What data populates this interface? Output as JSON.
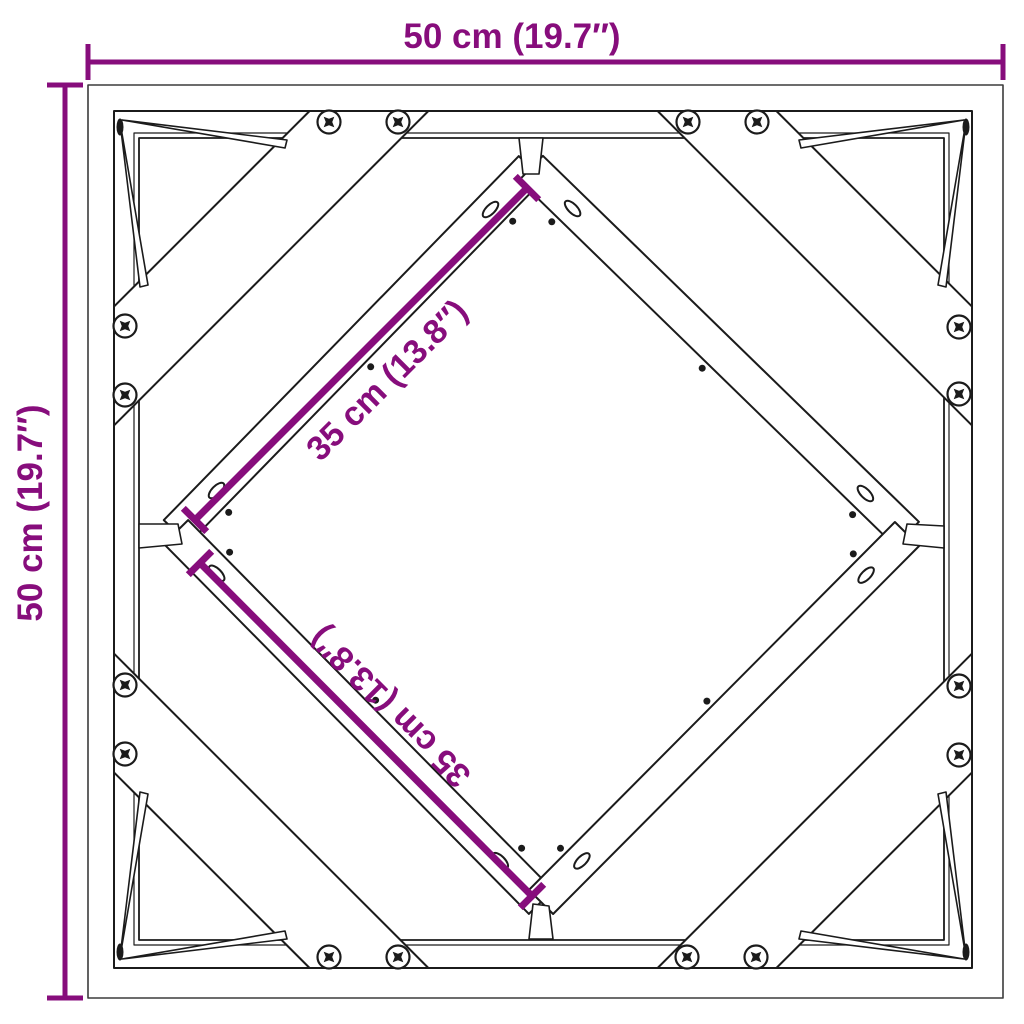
{
  "diagram": {
    "description": "Top view dimension drawing of a square frame with diagonal cross bracing",
    "labels": {
      "width": "50 cm (19.7″)",
      "height": "50 cm (19.7″)",
      "diagonal_upper": "35 cm (13.8″)",
      "diagonal_lower": "35 cm (13.8″)"
    },
    "colors": {
      "dimension_accent": "#870D7C",
      "line": "#1b1b1b",
      "background": "#FFFFFF"
    }
  }
}
